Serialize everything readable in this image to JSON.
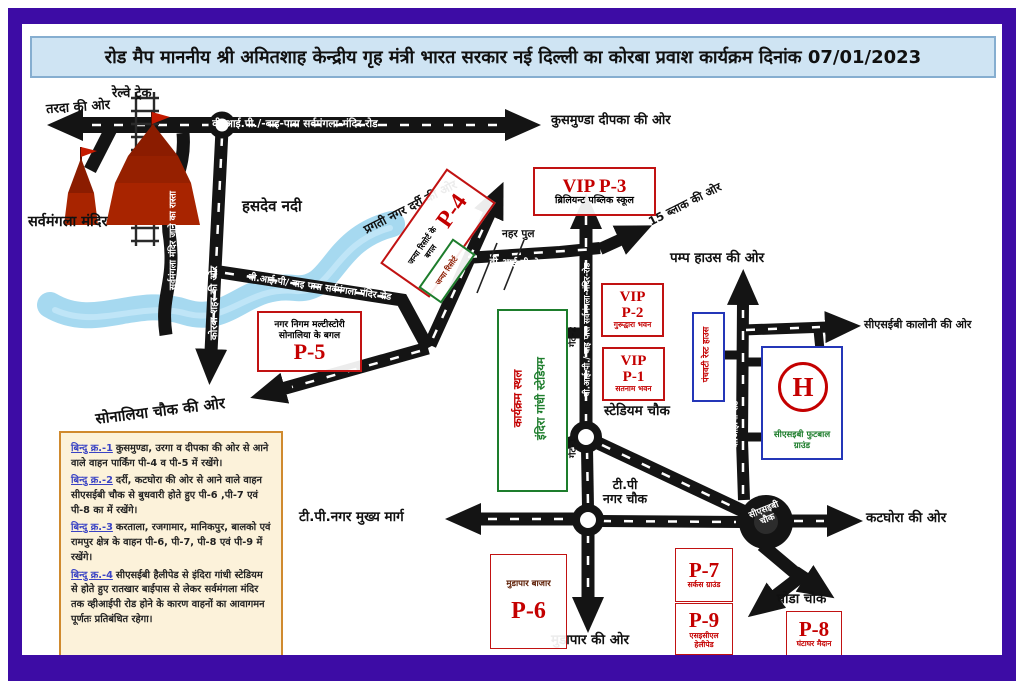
{
  "title": "रोड मैप माननीय श्री अमितशाह केन्द्रीय गृह मंत्री भारत सरकार नई दिल्ली का कोरबा प्रवाश कार्यक्रम दिनांक 07/01/2023",
  "colors": {
    "frame": "#3d0ca5",
    "title_bg": "#cfe4f3",
    "red": "#c40000",
    "green": "#1d7d2c",
    "blue": "#2436b8",
    "river": "#a6d9f0",
    "notes_border": "#d08a2e"
  },
  "landmarks": {
    "railway": "रेल्वे ट्रेक",
    "temple": "सर्वमंगला मंदिर",
    "river": "हसदेव नदी",
    "canal_bridge": "नहर पुल",
    "stadium_line1": "इंदिरा गांधी स्टेडियम",
    "stadium_line2": "कार्यक्रम स्थल",
    "rest_house": "पंचवटी रेस्ट हाउस",
    "football_ground": "सीएसइबी फुटबाल ग्राउंड",
    "helipad_letter": "H"
  },
  "directions": {
    "tarda": "तरदा की ओर",
    "kusmunda": "कुसमुण्डा दीपका की ओर",
    "pragati": "प्रगती नगर दर्री की ओर",
    "block15": "15 ब्लाक की ओर",
    "pump_house": "पम्प हाउस की ओर",
    "cseb_colony": "सीएसईबी कालोनी की ओर",
    "sonaliya": "सोनालिया चौक की ओर",
    "mudapar": "मुडापार की ओर",
    "katghora": "कटघोरा की ओर",
    "korba_city": "कोरबा शहर की ओर"
  },
  "roads": {
    "top_road": "वी.आई.पी./-बाइ-पास सर्वमंगला-मंदिर रोड",
    "bypass_diag": "वी.आई.पी/ वाइ पास सर्वमंगला मंदिर रोड",
    "canal_vip": "वी.आई.पी रोड",
    "vip_bypass_vert": "वी.आई.पी./ बाइ पास सर्वमंगला-मंदिर-रोड",
    "stadium_vip": "स्टेडियम-वी.आई.पी.-रोड",
    "vip_road_right": "वी.आई.पी-रोड",
    "tp_main": "टी.पी.नगर मुख्य मार्ग",
    "temple_path": "सर्वमंगला मंदिर जाने का रास्ता"
  },
  "chowks": {
    "stadium": "स्टेडियम चौक",
    "tp_l1": "टी.पी",
    "tp_l2": "नगर चौक",
    "cseb_l1": "सीएसइबी",
    "cseb_l2": "चौक",
    "ghoda": "घोडा चौक"
  },
  "gates": {
    "g1": "गेट-1",
    "g2": "गेट-2",
    "g3": "गेट-3"
  },
  "parking": {
    "p4": {
      "code": "P-4",
      "desc": "जन्या रिसोर्ट के बगल",
      "resort": "जन्या रिसोर्ट"
    },
    "p5": {
      "desc1": "नगर निगम मल्टीस्टोरी",
      "desc2": "सोनालिया के बगल",
      "code": "P-5"
    },
    "p6": {
      "desc": "मुडापार बाजार",
      "code": "P-6"
    },
    "p7": {
      "code": "P-7",
      "desc": "सर्कस ग्राउंड"
    },
    "p8": {
      "code": "P-8",
      "desc": "घंटाघर मैदान"
    },
    "p9": {
      "code": "P-9",
      "desc": "एसइसीएल हेलीपेड"
    }
  },
  "vip": {
    "p3": {
      "code": "VIP P-3",
      "desc": "ब्रिलियन्ट पब्लिक स्कूल"
    },
    "p2": {
      "l1": "VIP",
      "l2": "P-2",
      "desc": "गुरूद्वारा भवन"
    },
    "p1": {
      "l1": "VIP",
      "l2": "P-1",
      "desc": "सतनाम भवन"
    }
  },
  "notes": [
    {
      "head": "बिन्दु क्र.-1",
      "body": "कुसमुण्डा, उरगा व दीपका की ओर से आने वाले वाहन पार्किंग पी-4 व पी-5 में रखेंगे।"
    },
    {
      "head": "बिन्दु क्र.-2",
      "body": "दर्री, कटघोरा की ओर से आने वाले वाहन सीएसईबी चौक से बुधवारी होते हुए पी-6 ,पी-7 एवं पी-8 का में रखेंगे।"
    },
    {
      "head": "बिन्दु क्र.-3",
      "body": "करताला, रजगामार, मानिकपुर, बालको एवं रामपुर क्षेत्र के वाहन पी-6, पी-7, पी-8 एवं पी-9 में रखेंगे।"
    },
    {
      "head": "बिन्दु क्र.-4",
      "body": "सीएसईबी हैलीपेड से इंदिरा गांधी स्टेडियम से होते हुए रातखार बाईपास से लेकर सर्वमंगला मंदिर तक व्हीआईपी रोड होने के कारण वाहनों का आवागमन पूर्णतः प्रतिबंधित रहेगा।"
    }
  ]
}
